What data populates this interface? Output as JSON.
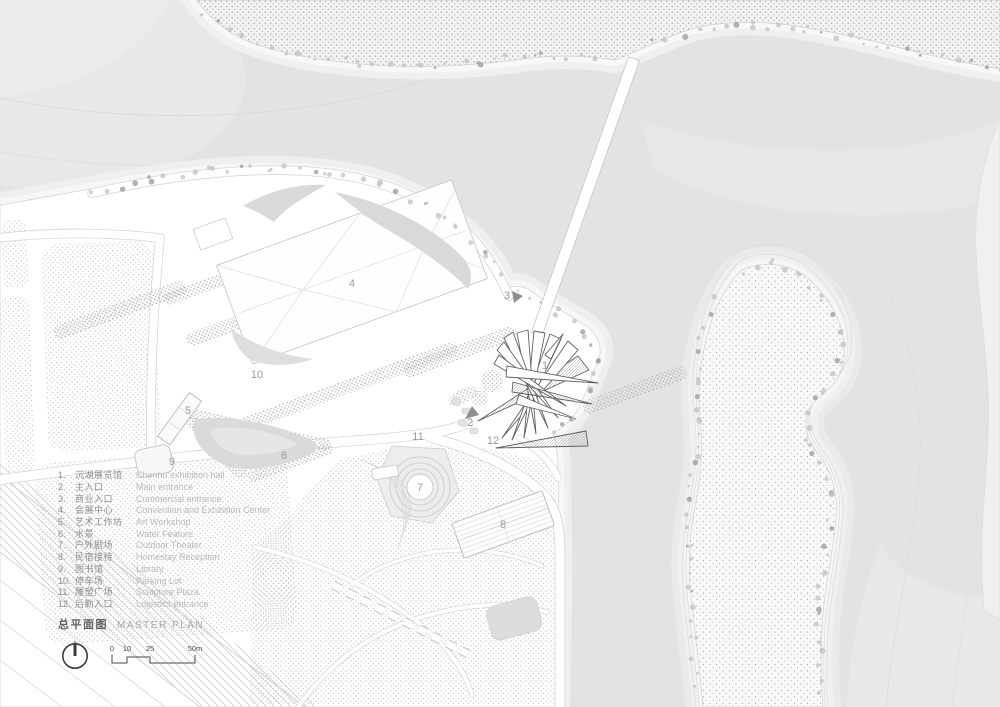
{
  "title": {
    "zh": "总平面图",
    "en": "MASTER PLAN"
  },
  "legend": {
    "items": [
      {
        "num": "1.",
        "zh": "沉湖展览馆",
        "en": "Chenhu exhibition hall"
      },
      {
        "num": "2.",
        "zh": "主入口",
        "en": "Main entrance"
      },
      {
        "num": "3.",
        "zh": "商业入口",
        "en": "Commercial entrance"
      },
      {
        "num": "4.",
        "zh": "会展中心",
        "en": "Convention and Exhibition Center"
      },
      {
        "num": "5.",
        "zh": "艺术工作坊",
        "en": "Art Workshop"
      },
      {
        "num": "6.",
        "zh": "水景",
        "en": "Water Feature"
      },
      {
        "num": "7.",
        "zh": "户外剧场",
        "en": "Outdoor Theater"
      },
      {
        "num": "8.",
        "zh": "民宿接待",
        "en": "Homestay Reception"
      },
      {
        "num": "9.",
        "zh": "图书馆",
        "en": "Library"
      },
      {
        "num": "10.",
        "zh": "停车场",
        "en": "Parking Lot"
      },
      {
        "num": "11.",
        "zh": "雕塑广场",
        "en": "Sculpture Plaza"
      },
      {
        "num": "12.",
        "zh": "后勤入口",
        "en": "Logistics entrance"
      }
    ]
  },
  "scale_bar": {
    "labels": [
      "0",
      "10",
      "25",
      "50m"
    ]
  },
  "icons": {
    "north_arrow": "north-compass-icon"
  },
  "plan_labels": [
    {
      "n": "1",
      "x": 545,
      "y": 369
    },
    {
      "n": "2",
      "x": 470,
      "y": 426
    },
    {
      "n": "3",
      "x": 507,
      "y": 299
    },
    {
      "n": "4",
      "x": 352,
      "y": 287
    },
    {
      "n": "5",
      "x": 188,
      "y": 414
    },
    {
      "n": "6",
      "x": 284,
      "y": 459
    },
    {
      "n": "7",
      "x": 420,
      "y": 491
    },
    {
      "n": "8",
      "x": 503,
      "y": 528
    },
    {
      "n": "9",
      "x": 172,
      "y": 465
    },
    {
      "n": "10",
      "x": 257,
      "y": 378
    },
    {
      "n": "11",
      "x": 418,
      "y": 440
    },
    {
      "n": "12",
      "x": 493,
      "y": 444
    }
  ],
  "colors": {
    "water": "#e3e3e4",
    "land": "#ffffff",
    "shore_halo": "#eff0f0",
    "label": "#9a9a9a",
    "legend_zh": "#8c8c8c",
    "legend_en": "#b9b9b9",
    "title_zh": "#5f5f5f",
    "title_en": "#a8a8a8",
    "cluster_outline": "#606060",
    "compass": "#3c3c3c"
  }
}
